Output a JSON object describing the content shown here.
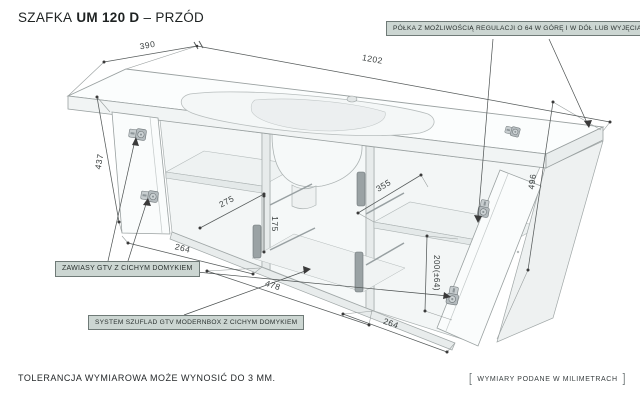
{
  "title": {
    "product": "SZAFKA",
    "model": "UM 120 D",
    "view": "– PRZÓD"
  },
  "callouts": {
    "shelf": "PÓŁKA Z MOŻLIWOŚCIĄ REGULACJI O 64 W GÓRĘ I W DÓŁ LUB WYJĘCIA",
    "hinges": "ZAWIASY GTV Z CICHYM DOMYKIEM",
    "drawers": "SYSTEM SZUFLAD GTV MODERNBOX Z CICHYM DOMYKIEM"
  },
  "dimensions": {
    "top_depth": "390",
    "top_width": "1202",
    "left_height": "437",
    "left_section_width": "264",
    "drawer_inner_depth": "275",
    "drawer_inner_height": "175",
    "drawer_width": "478",
    "shelf_depth": "355",
    "shelf_height_adjust": "200(±64)",
    "right_section_width": "264",
    "right_height": "496"
  },
  "footer": {
    "tolerance": "TOLERANCJA WYMIAROWA MOŻE WYNOSIĆ DO 3 MM.",
    "bracket_open": "[",
    "units_note": "WYMIARY PODANE W MILIMETRACH",
    "bracket_close": "]"
  },
  "colors": {
    "background": "#ffffff",
    "callout_bg": "#ccd6d2",
    "callout_border": "#6f7a77",
    "dimension_line": "#565b5b",
    "text": "#1e2222"
  }
}
